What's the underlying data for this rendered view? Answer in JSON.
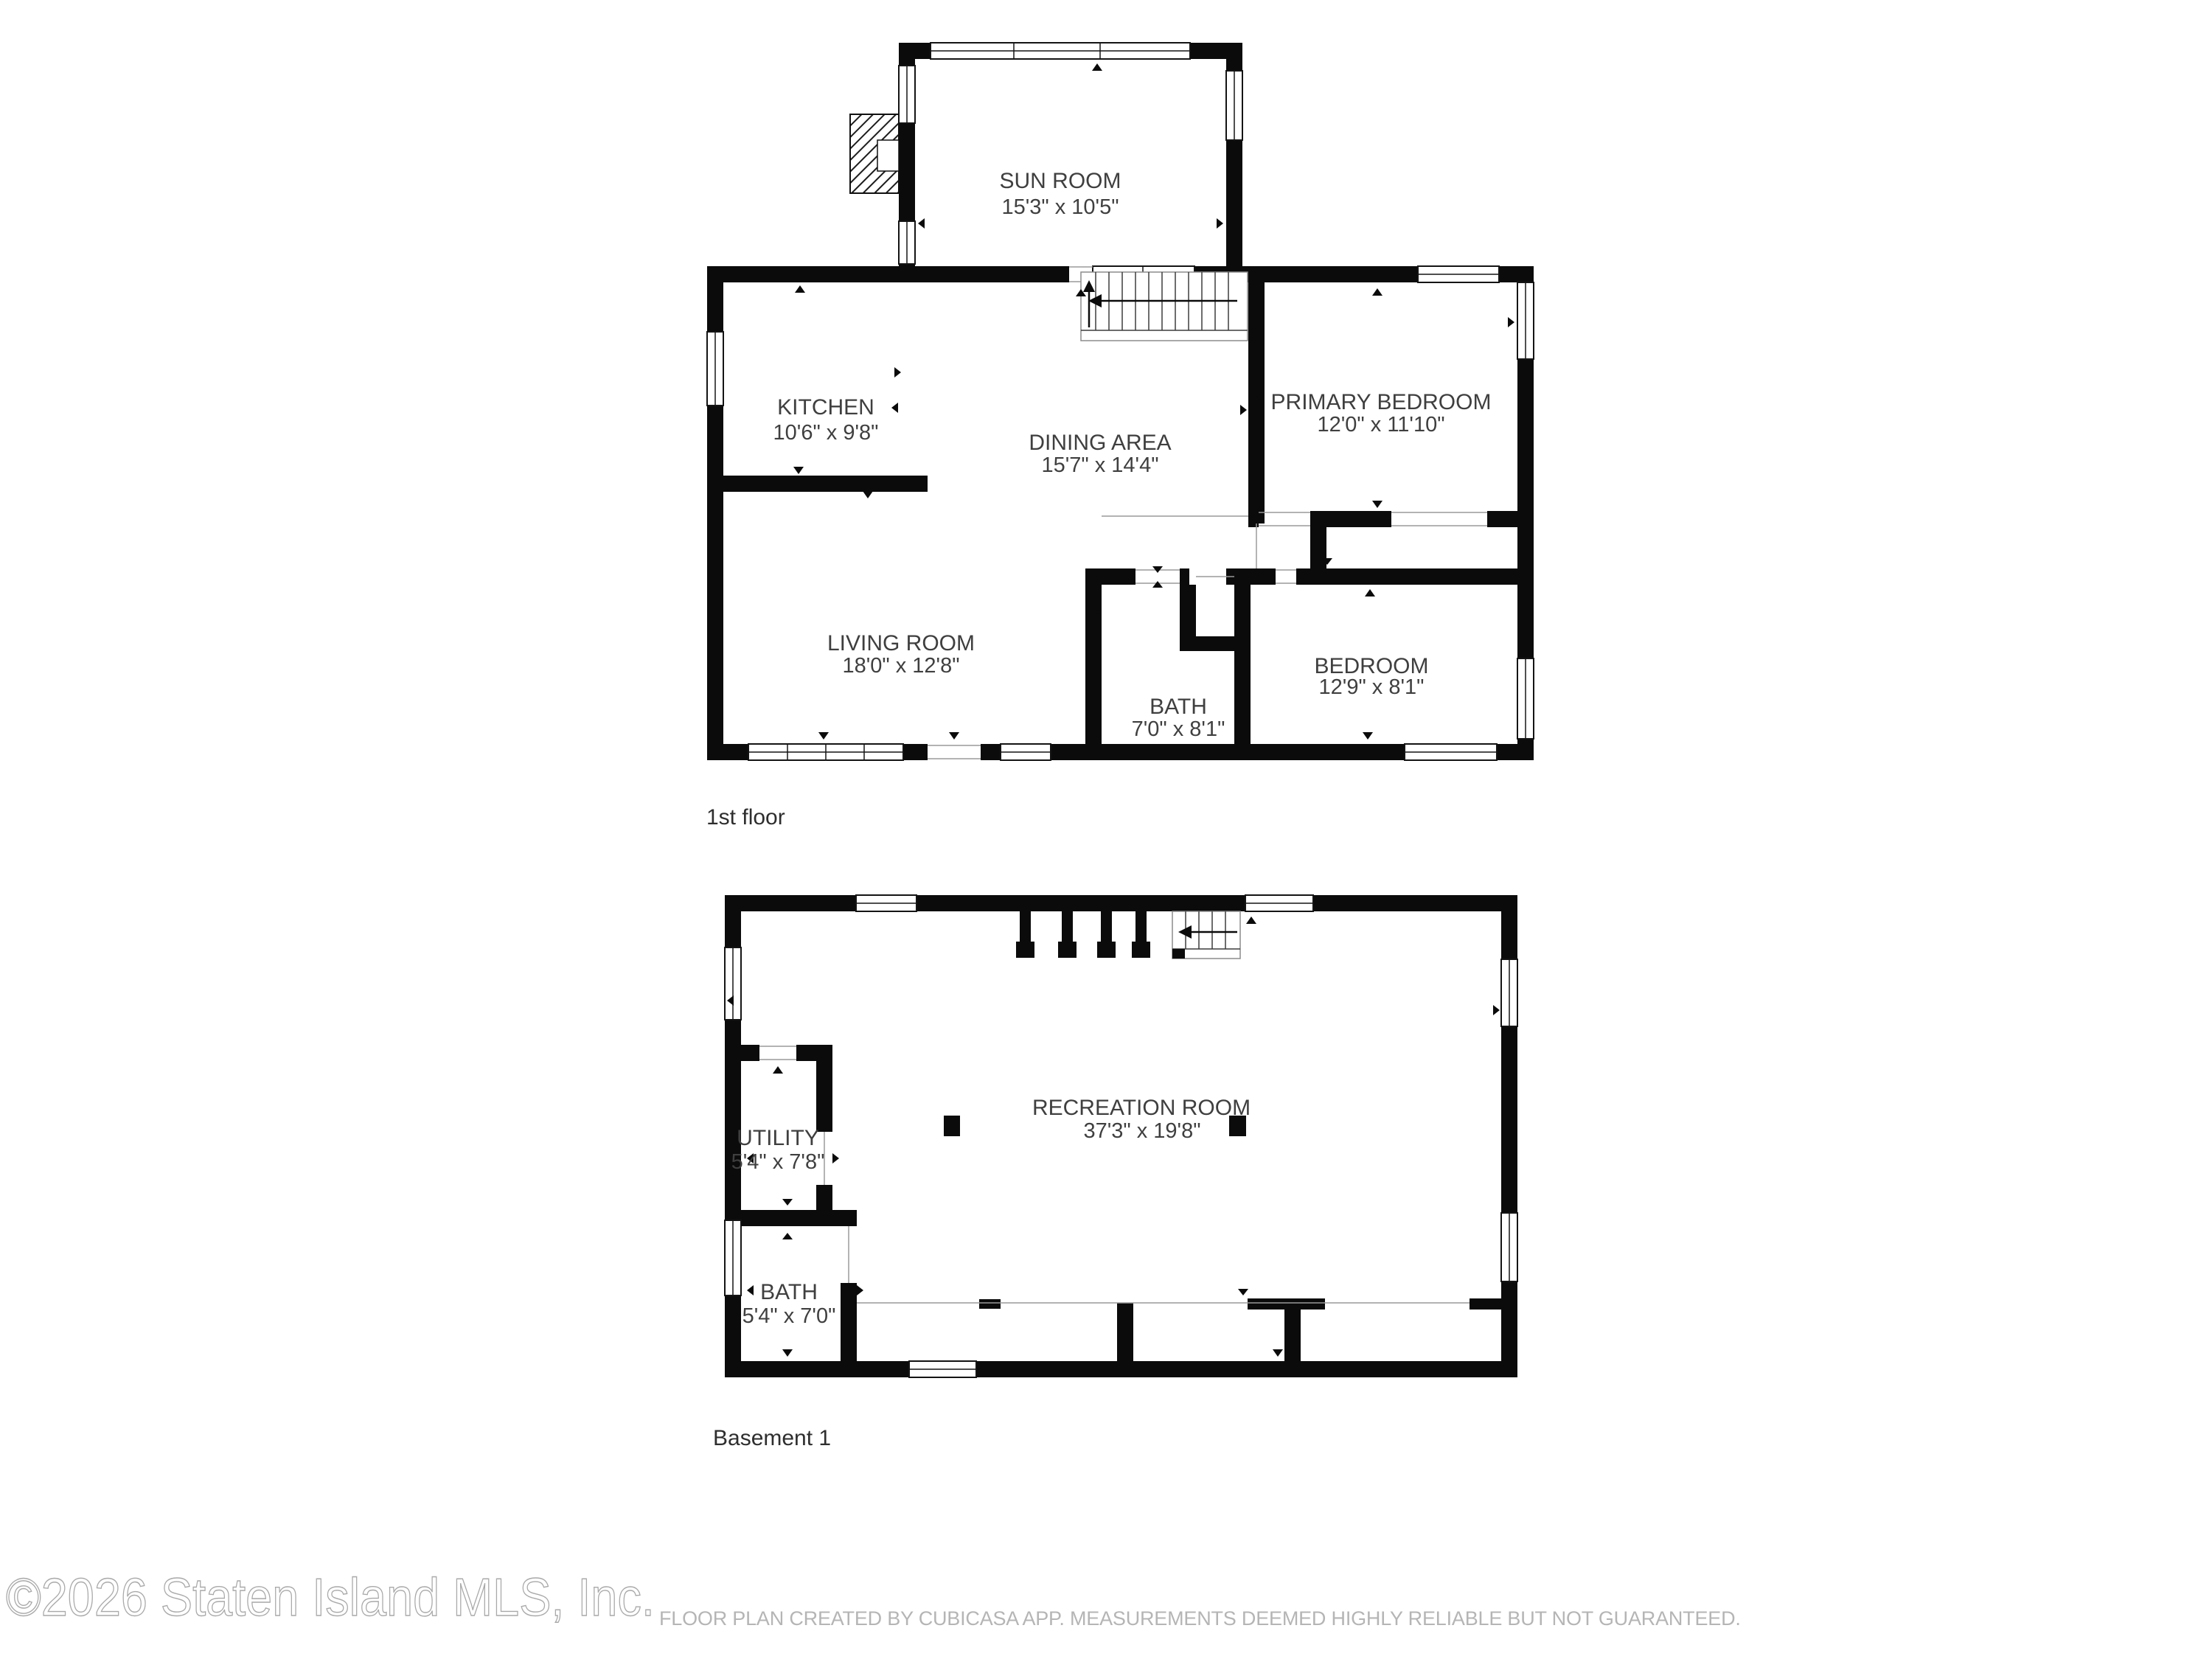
{
  "plan_type": "residential floor plan",
  "floor1": {
    "label": "1st floor",
    "rooms": {
      "sun_room": {
        "name": "SUN ROOM",
        "dims": "15'3\" x 10'5\""
      },
      "kitchen": {
        "name": "KITCHEN",
        "dims": "10'6\" x 9'8\""
      },
      "dining": {
        "name": "DINING AREA",
        "dims": "15'7\" x 14'4\""
      },
      "primary_bedroom": {
        "name": "PRIMARY BEDROOM",
        "dims": "12'0\" x 11'10\""
      },
      "living_room": {
        "name": "LIVING ROOM",
        "dims": "18'0\" x 12'8\""
      },
      "bath": {
        "name": "BATH",
        "dims": "7'0\" x 8'1\""
      },
      "bedroom": {
        "name": "BEDROOM",
        "dims": "12'9\" x 8'1\""
      }
    }
  },
  "basement": {
    "label": "Basement 1",
    "rooms": {
      "recreation_room": {
        "name": "RECREATION ROOM",
        "dims": "37'3\" x 19'8\""
      },
      "utility": {
        "name": "UTILITY",
        "dims": "5'4\" x 7'8\""
      },
      "bath": {
        "name": "BATH",
        "dims": "5'4\" x 7'0\""
      }
    }
  },
  "footer": {
    "watermark": "©2026 Staten Island MLS, Inc.",
    "disclaimer": "FLOOR PLAN CREATED BY CUBICASA APP. MEASUREMENTS DEEMED HIGHLY RELIABLE BUT NOT GUARANTEED."
  },
  "colors": {
    "wall": "#0b0b0b",
    "label_text": "#3f3f3f",
    "floor_label_text": "#2e2e2e",
    "watermark_outline": "#a9a9a9",
    "disclaimer_text": "#b5b5b5"
  }
}
